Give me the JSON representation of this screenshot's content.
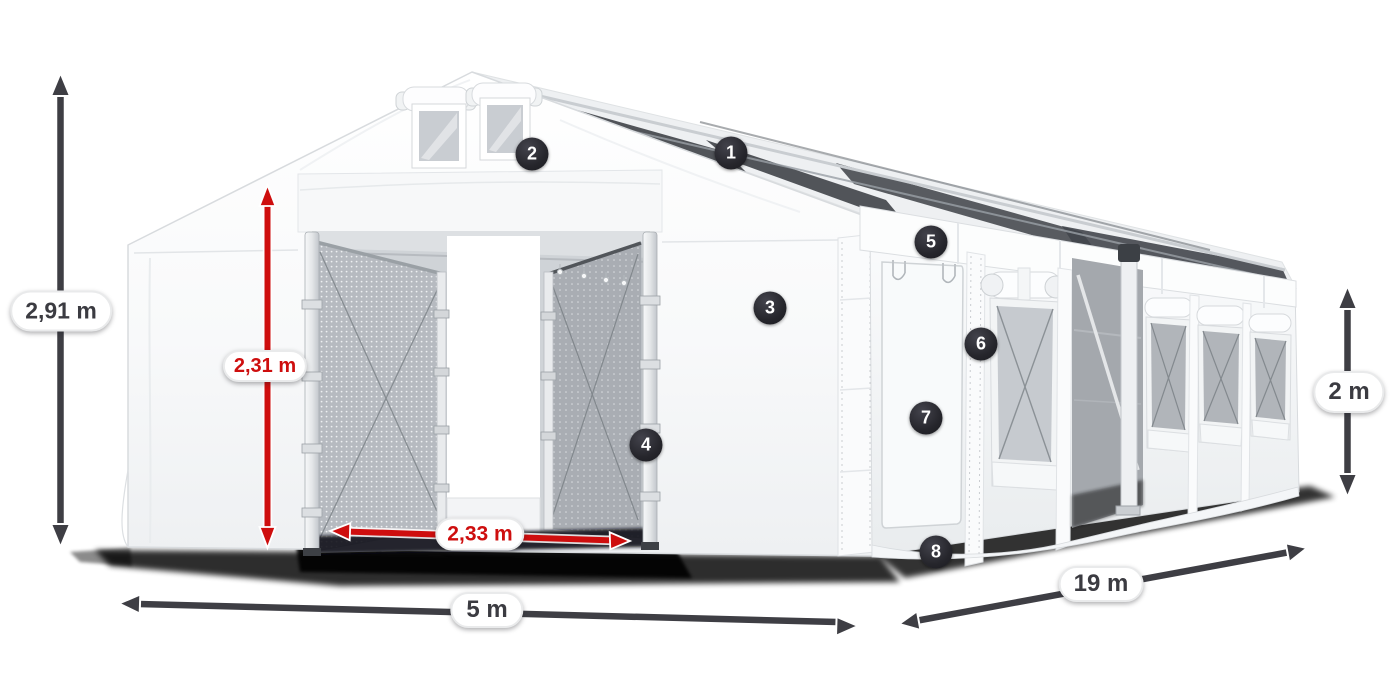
{
  "colors": {
    "accent_red": "#ce0e0e",
    "dimension_dark": "#3e3e44",
    "callout_background": "#26262c",
    "pill_background": "#ffffff",
    "tent_white": "#ffffff",
    "mesh_gray": "#b6bac0",
    "skylight_dark": "#43464c"
  },
  "dimensions": {
    "total_height": "2,91 m",
    "door_height": "2,31 m",
    "door_width": "2,33 m",
    "front_width": "5 m",
    "side_length": "19 m",
    "wall_height": "2 m"
  },
  "callouts": [
    {
      "number": "1"
    },
    {
      "number": "2"
    },
    {
      "number": "3"
    },
    {
      "number": "4"
    },
    {
      "number": "5"
    },
    {
      "number": "6"
    },
    {
      "number": "7"
    },
    {
      "number": "8"
    }
  ]
}
